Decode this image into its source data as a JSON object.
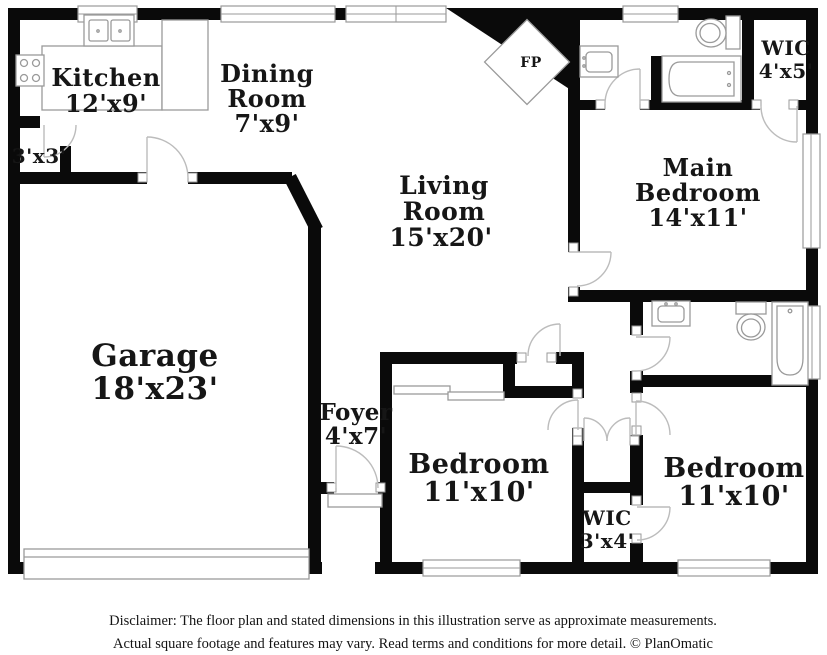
{
  "floor_plan": {
    "fireplace_label": "FP",
    "rooms": [
      {
        "id": "kitchen",
        "label_lines": [
          "Kitchen"
        ],
        "dimensions": "12'x9'"
      },
      {
        "id": "dining-room",
        "label_lines": [
          "Dining",
          "Room"
        ],
        "dimensions": "7'x9'"
      },
      {
        "id": "entry-closet",
        "label_lines": [],
        "dimensions": "3'x3'"
      },
      {
        "id": "living-room",
        "label_lines": [
          "Living",
          "Room"
        ],
        "dimensions": "15'x20'"
      },
      {
        "id": "wic-main",
        "label_lines": [
          "WIC"
        ],
        "dimensions": "4'x5'"
      },
      {
        "id": "main-bedroom",
        "label_lines": [
          "Main",
          "Bedroom"
        ],
        "dimensions": "14'x11'"
      },
      {
        "id": "garage",
        "label_lines": [
          "Garage"
        ],
        "dimensions": "18'x23'"
      },
      {
        "id": "foyer",
        "label_lines": [
          "Foyer"
        ],
        "dimensions": "4'x7'"
      },
      {
        "id": "bedroom-front",
        "label_lines": [
          "Bedroom"
        ],
        "dimensions": "11'x10'"
      },
      {
        "id": "bedroom-rear",
        "label_lines": [
          "Bedroom"
        ],
        "dimensions": "11'x10'"
      },
      {
        "id": "wic-hall",
        "label_lines": [
          "WIC"
        ],
        "dimensions": "3'x4'"
      }
    ]
  },
  "disclaimer": {
    "line1": "Disclaimer: The floor plan and stated dimensions in this illustration serve as approximate measurements.",
    "line2": "Actual square footage and features may vary. Read terms and conditions for more detail. © PlanOmatic"
  },
  "colors": {
    "wall": "#0a0a0a",
    "fixture_line": "#9a9a9a",
    "door_arc": "#bcbcbc",
    "label_text": "#161616",
    "background": "#ffffff"
  }
}
